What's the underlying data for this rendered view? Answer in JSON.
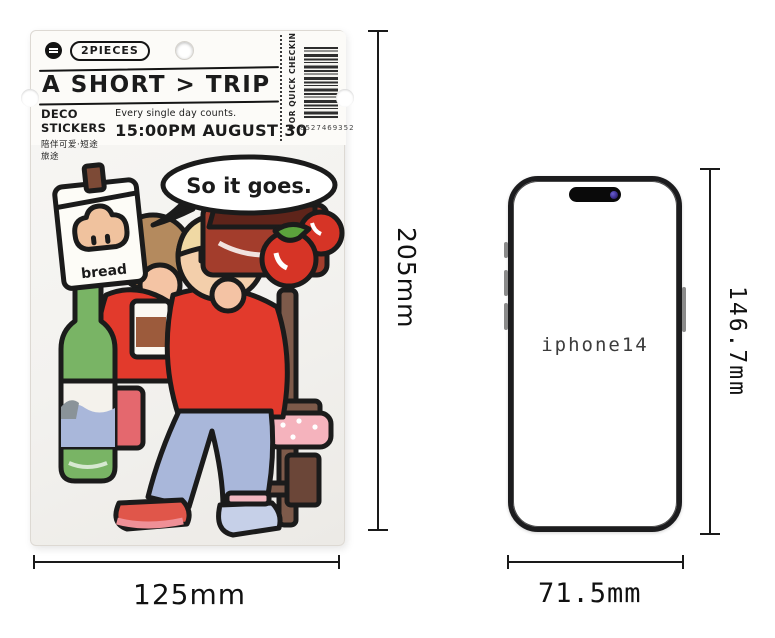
{
  "package": {
    "pieces_badge": "2PIECES",
    "title": "A SHORT > TRIP",
    "category": "DECO STICKERS",
    "category_cn": "陪伴可爱·短途旅途",
    "tagline": "Every single day counts.",
    "event_time": "15:00PM AUGUST 30",
    "side_text": "FOR QUICK CHECKIN",
    "barcode_number": "8527469352",
    "illustration": {
      "speech_bubble": "So it goes.",
      "bread_label": "bread"
    },
    "icons": {
      "brand_logo": "black-circle-logo",
      "hang_hole": "round-hang-hole",
      "barcode": "barcode-stripes"
    }
  },
  "phone": {
    "label": "iphone14"
  },
  "dimensions": {
    "package_height": "205mm",
    "package_width": "125mm",
    "phone_height": "146.7mm",
    "phone_width": "71.5mm"
  },
  "colors": {
    "sticker_red": "#e23a2c",
    "jeans_blue": "#a9b7da",
    "bottle_green": "#79b465",
    "chair_brown": "#7d5a4a",
    "line_black": "#1b1b1b",
    "camera_dot_purple": "#3c2f8f"
  }
}
